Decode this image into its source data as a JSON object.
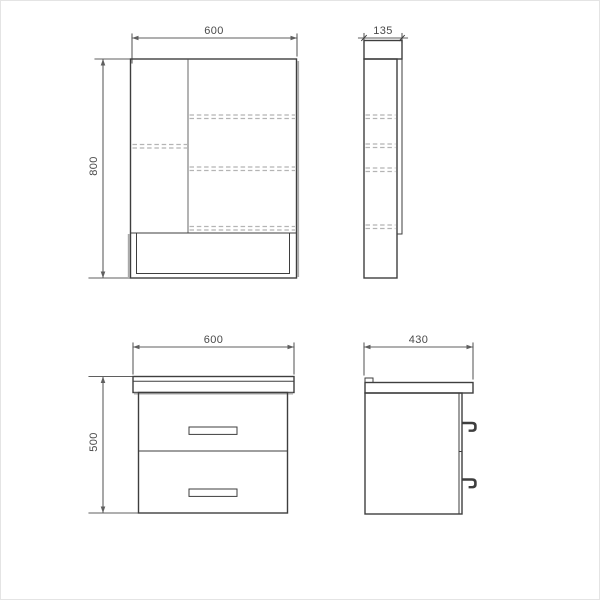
{
  "colors": {
    "line": "#3e3e3e",
    "line_mid": "#757575",
    "line_soft": "#a9a9a9",
    "dashed": "#b4b4b4",
    "dim": "#5f5f5f",
    "text": "#4a4a4a",
    "background": "#ffffff"
  },
  "views": {
    "mirror_front": {
      "width_label": "600",
      "height_label": "800"
    },
    "mirror_side": {
      "depth_label": "135"
    },
    "vanity_front": {
      "width_label": "600",
      "height_label": "500"
    },
    "vanity_side": {
      "depth_label": "430"
    }
  }
}
